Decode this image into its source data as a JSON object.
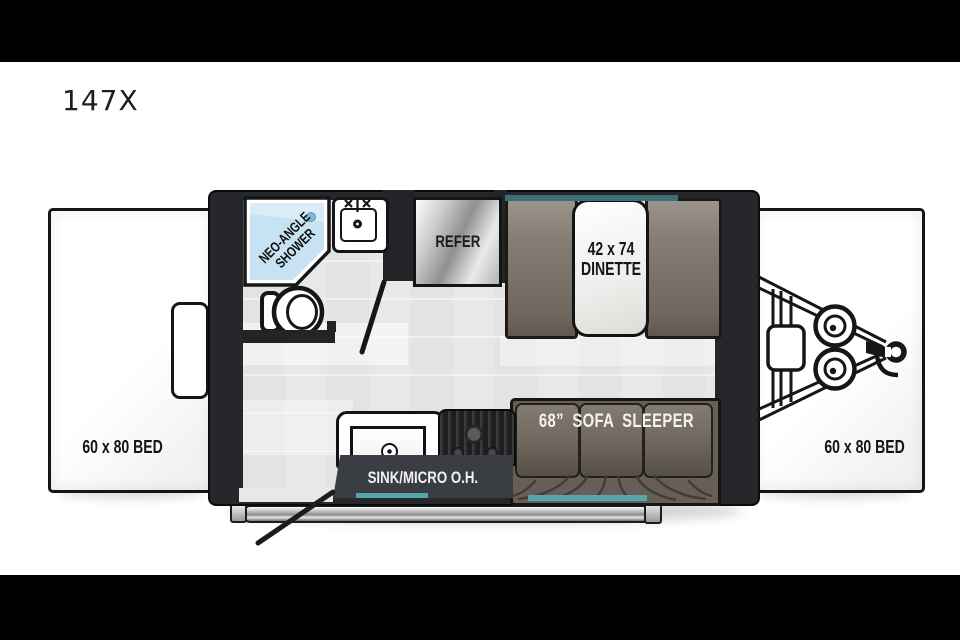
{
  "title": "147X",
  "floorplan": {
    "left_bed": {
      "label": "60 x 80 BED"
    },
    "right_bed": {
      "label": "60 x 80 BED"
    },
    "bathroom": {
      "shower_line1": "NEO-ANGLE",
      "shower_line2": "SHOWER"
    },
    "kitchen": {
      "refer": "REFER",
      "overhead": "SINK/MICRO O.H."
    },
    "dinette": {
      "line1": "42 x 74",
      "line2": "DINETTE"
    },
    "sofa": {
      "label": "68” SOFA SLEEPER"
    },
    "colors": {
      "accent_teal_dark": "#3c6f75",
      "accent_teal_light": "#57a6ac",
      "shower_blue": "#cfe7f5",
      "upholstery_brown": "#6e655c",
      "wall_black": "#232428"
    }
  }
}
